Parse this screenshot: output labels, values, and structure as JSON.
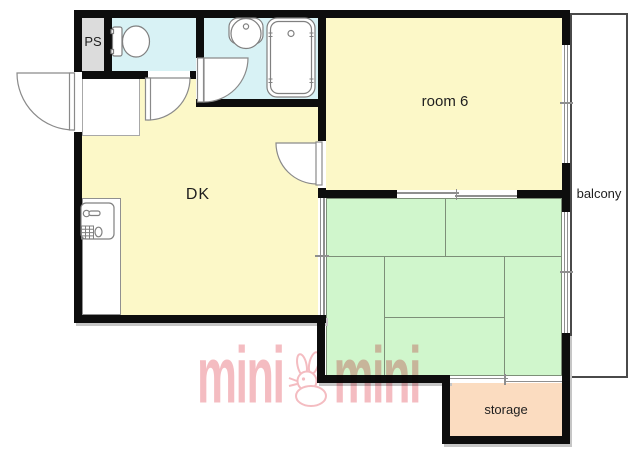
{
  "title": "apartment floor plan",
  "rooms": {
    "ps": {
      "label": "PS",
      "fill": "#dcdcdc"
    },
    "toilet": {
      "fill": "#d8f2f5"
    },
    "bathroom": {
      "fill": "#d8f2f5"
    },
    "dk": {
      "label": "DK",
      "fill": "#fcf8c8"
    },
    "room6": {
      "label": "room 6",
      "fill": "#fcf8c8"
    },
    "tatami": {
      "fill": "#d0f6cc",
      "mats": 6
    },
    "balcony": {
      "label": "balcony",
      "fill": "#ffffff"
    },
    "storage": {
      "label": "storage",
      "fill": "#fbdcc0"
    }
  },
  "fixtures": [
    "toilet",
    "washbasin",
    "bathtub",
    "kitchen-sink"
  ],
  "branding": {
    "watermark_left": "mini",
    "watermark_right": "mini",
    "mascot": "rabbit"
  },
  "colors": {
    "bg": "#ffffff",
    "wall": "#0d0d0d",
    "watermark": "#f1a9af",
    "fixture-line": "#808080",
    "window-line": "#8f8f8f",
    "mat-line": "#7d8f78",
    "label": "#1f1f1f",
    "shadow": "#c6c6c6"
  }
}
